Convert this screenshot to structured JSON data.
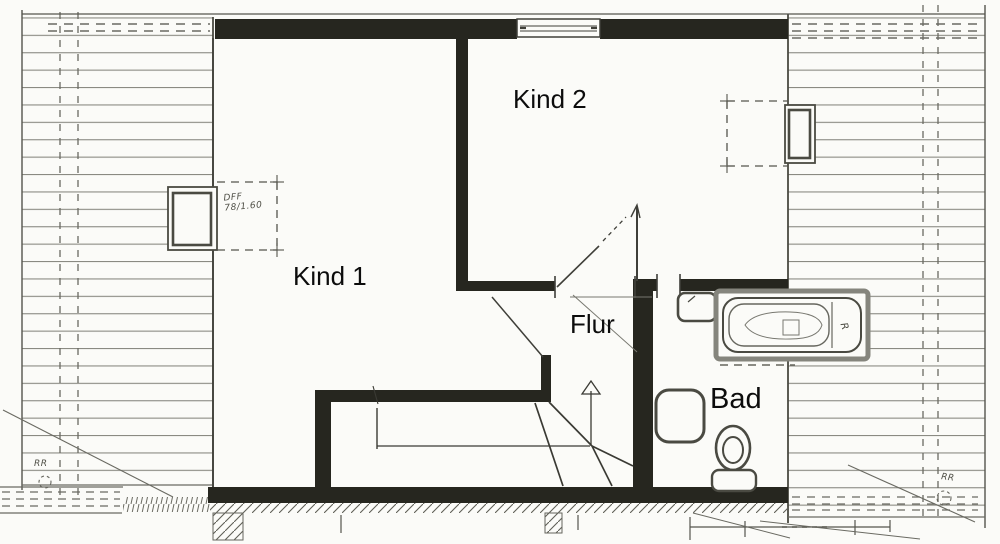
{
  "plan_title": "upper-floor-plan",
  "rooms": {
    "kind1": {
      "label": "Kind 1"
    },
    "kind2": {
      "label": "Kind 2"
    },
    "flur": {
      "label": "Flur"
    },
    "bad": {
      "label": "Bad"
    }
  },
  "annotations": {
    "skylight_line1": "DFF",
    "skylight_line2": "78/1.60",
    "rr_left": "RR",
    "rr_right": "RR",
    "tub_mark": "R"
  },
  "fixtures": [
    "bathtub",
    "washbasin",
    "toilet",
    "shower-tray",
    "winder-staircase",
    "skylight-left",
    "skylight-right",
    "window-top",
    "door-kind1",
    "door-kind2",
    "door-bad"
  ],
  "palette": {
    "paper": "#fbfbf8",
    "wall": "#26261f",
    "ink": "#3f3f39",
    "hatch": "#8a8a82",
    "tub_outline": "#85857d",
    "label_text": "#0c0c0c",
    "handwriting": "#4f4f46"
  }
}
